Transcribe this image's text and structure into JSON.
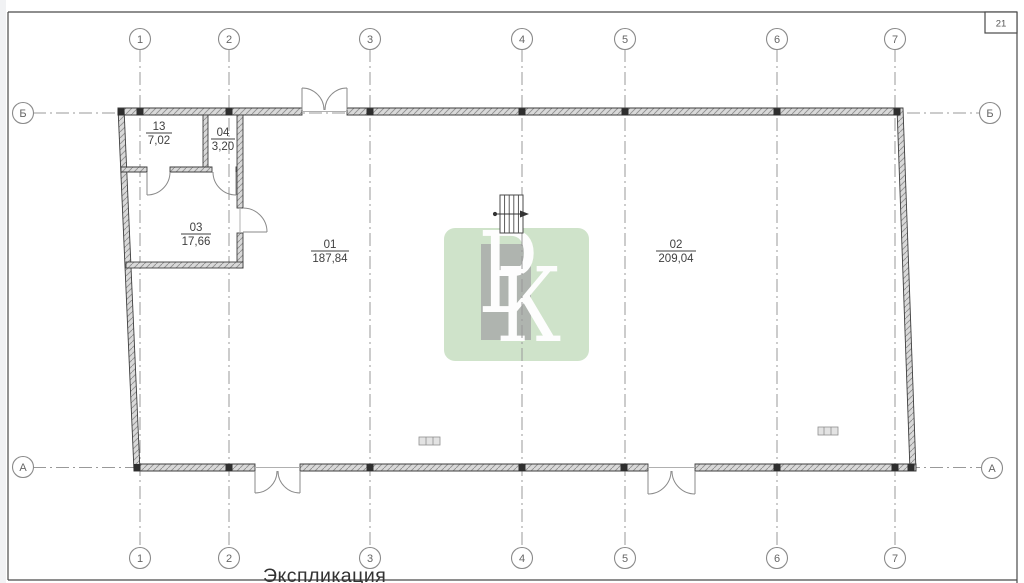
{
  "page": {
    "sheet_number": "21",
    "title": "Экспликация"
  },
  "grid": {
    "columns": [
      "1",
      "2",
      "3",
      "4",
      "5",
      "6",
      "7"
    ],
    "rows": [
      "Б",
      "А"
    ]
  },
  "rooms": [
    {
      "number": "13",
      "area": "7,02"
    },
    {
      "number": "04",
      "area": "3,20"
    },
    {
      "number": "03",
      "area": "17,66"
    },
    {
      "number": "01",
      "area": "187,84"
    },
    {
      "number": "02",
      "area": "209,04"
    }
  ],
  "watermark": {
    "letter_p": "Р",
    "letter_k": "К",
    "green_color": "#c9e0c3",
    "gray_color": "#9e9e9e"
  },
  "colors": {
    "wall_edge": "#3e3e3e",
    "wall_fill": "#d9d9d9",
    "axis_line": "#999999",
    "label_text": "#3f3f3f"
  }
}
